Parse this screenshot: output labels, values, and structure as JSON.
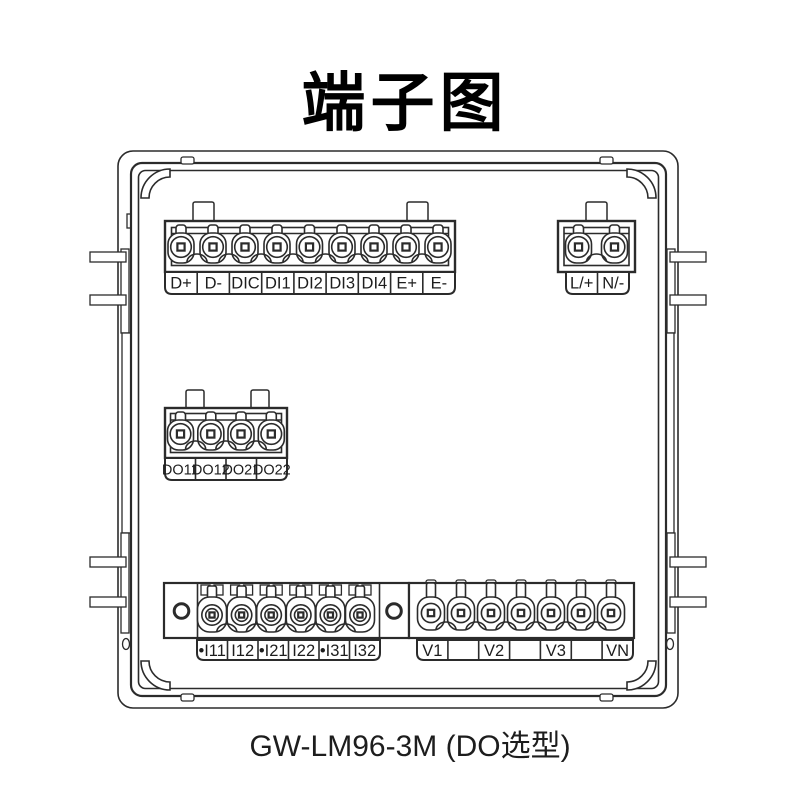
{
  "title": "端子图",
  "caption": "GW-LM96-3M (DO选型)",
  "colors": {
    "line": "#2b2b2b",
    "background": "#ffffff",
    "text": "#1d1d1d"
  },
  "blocks": {
    "comm": {
      "labels": [
        "D+",
        "D-",
        "DIC",
        "DI1",
        "DI2",
        "DI3",
        "DI4",
        "E+",
        "E-"
      ]
    },
    "power": {
      "labels": [
        "L/+",
        "N/-"
      ]
    },
    "do": {
      "labels": [
        "DO11",
        "DO12",
        "DO21",
        "DO22"
      ]
    },
    "current": {
      "labels": [
        "•I11",
        "I12",
        "•I21",
        "I22",
        "•I31",
        "I32"
      ]
    },
    "voltage": {
      "labels": [
        "V1",
        "",
        "V2",
        "",
        "V3",
        "",
        "VN"
      ]
    }
  }
}
